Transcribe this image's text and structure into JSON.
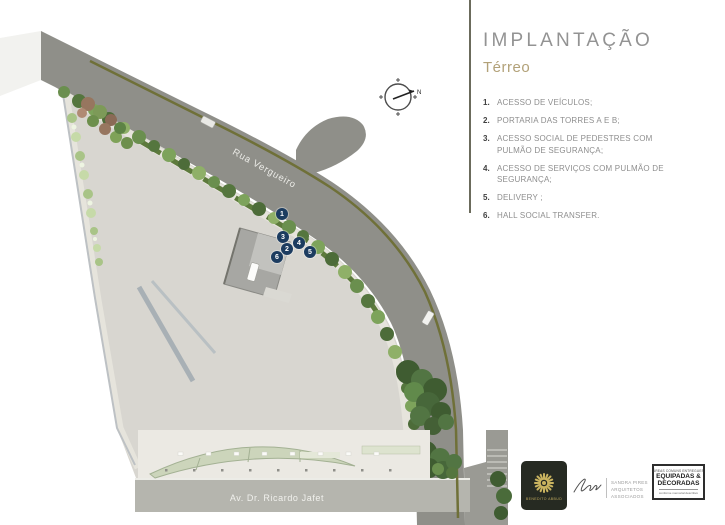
{
  "panel": {
    "title": "IMPLANTAÇÃO",
    "subtitle": "Térreo",
    "legend": [
      {
        "num": "1.",
        "text": "ACESSO DE VEÍCULOS;"
      },
      {
        "num": "2.",
        "text": "PORTARIA DAS TORRES A E B;"
      },
      {
        "num": "3.",
        "text": "ACESSO SOCIAL DE PEDESTRES COM PULMÃO DE SEGURANÇA;"
      },
      {
        "num": "4.",
        "text": "ACESSO DE SERVIÇOS COM PULMÃO DE SEGURANÇA;"
      },
      {
        "num": "5.",
        "text": "DELIVERY ;"
      },
      {
        "num": "6.",
        "text": "HALL SOCIAL TRANSFER."
      }
    ]
  },
  "map": {
    "street_label_top": "Rua Vergueiro",
    "street_label_bottom": "Av. Dr. Ricardo Jafet",
    "compass_label": "N",
    "markers": [
      "1",
      "2",
      "3",
      "4",
      "5",
      "6"
    ]
  },
  "logos": {
    "benedito": {
      "name": "BENEDITO ABBUD"
    },
    "sandra": {
      "lines": [
        "SANDRA PIRES",
        "ARQUITETOS",
        "ASSOCIADOS"
      ]
    },
    "equipadas": {
      "top": "ÁREAS COMUNS ENTREGUES",
      "main1": "EQUIPADAS &",
      "main2": "DECORADAS",
      "bottom": "conforme memorial descritivo"
    }
  },
  "colors": {
    "accent_gold": "#b2a178",
    "divider_olive": "#6b6b5c",
    "marker_navy": "#1c3c60",
    "street_gray": "#8f8f89",
    "site_gray": "#d8d6d0",
    "tree_green": "#5d8345",
    "logo_dark": "#262a22",
    "logo_gold": "#c9b35f"
  }
}
